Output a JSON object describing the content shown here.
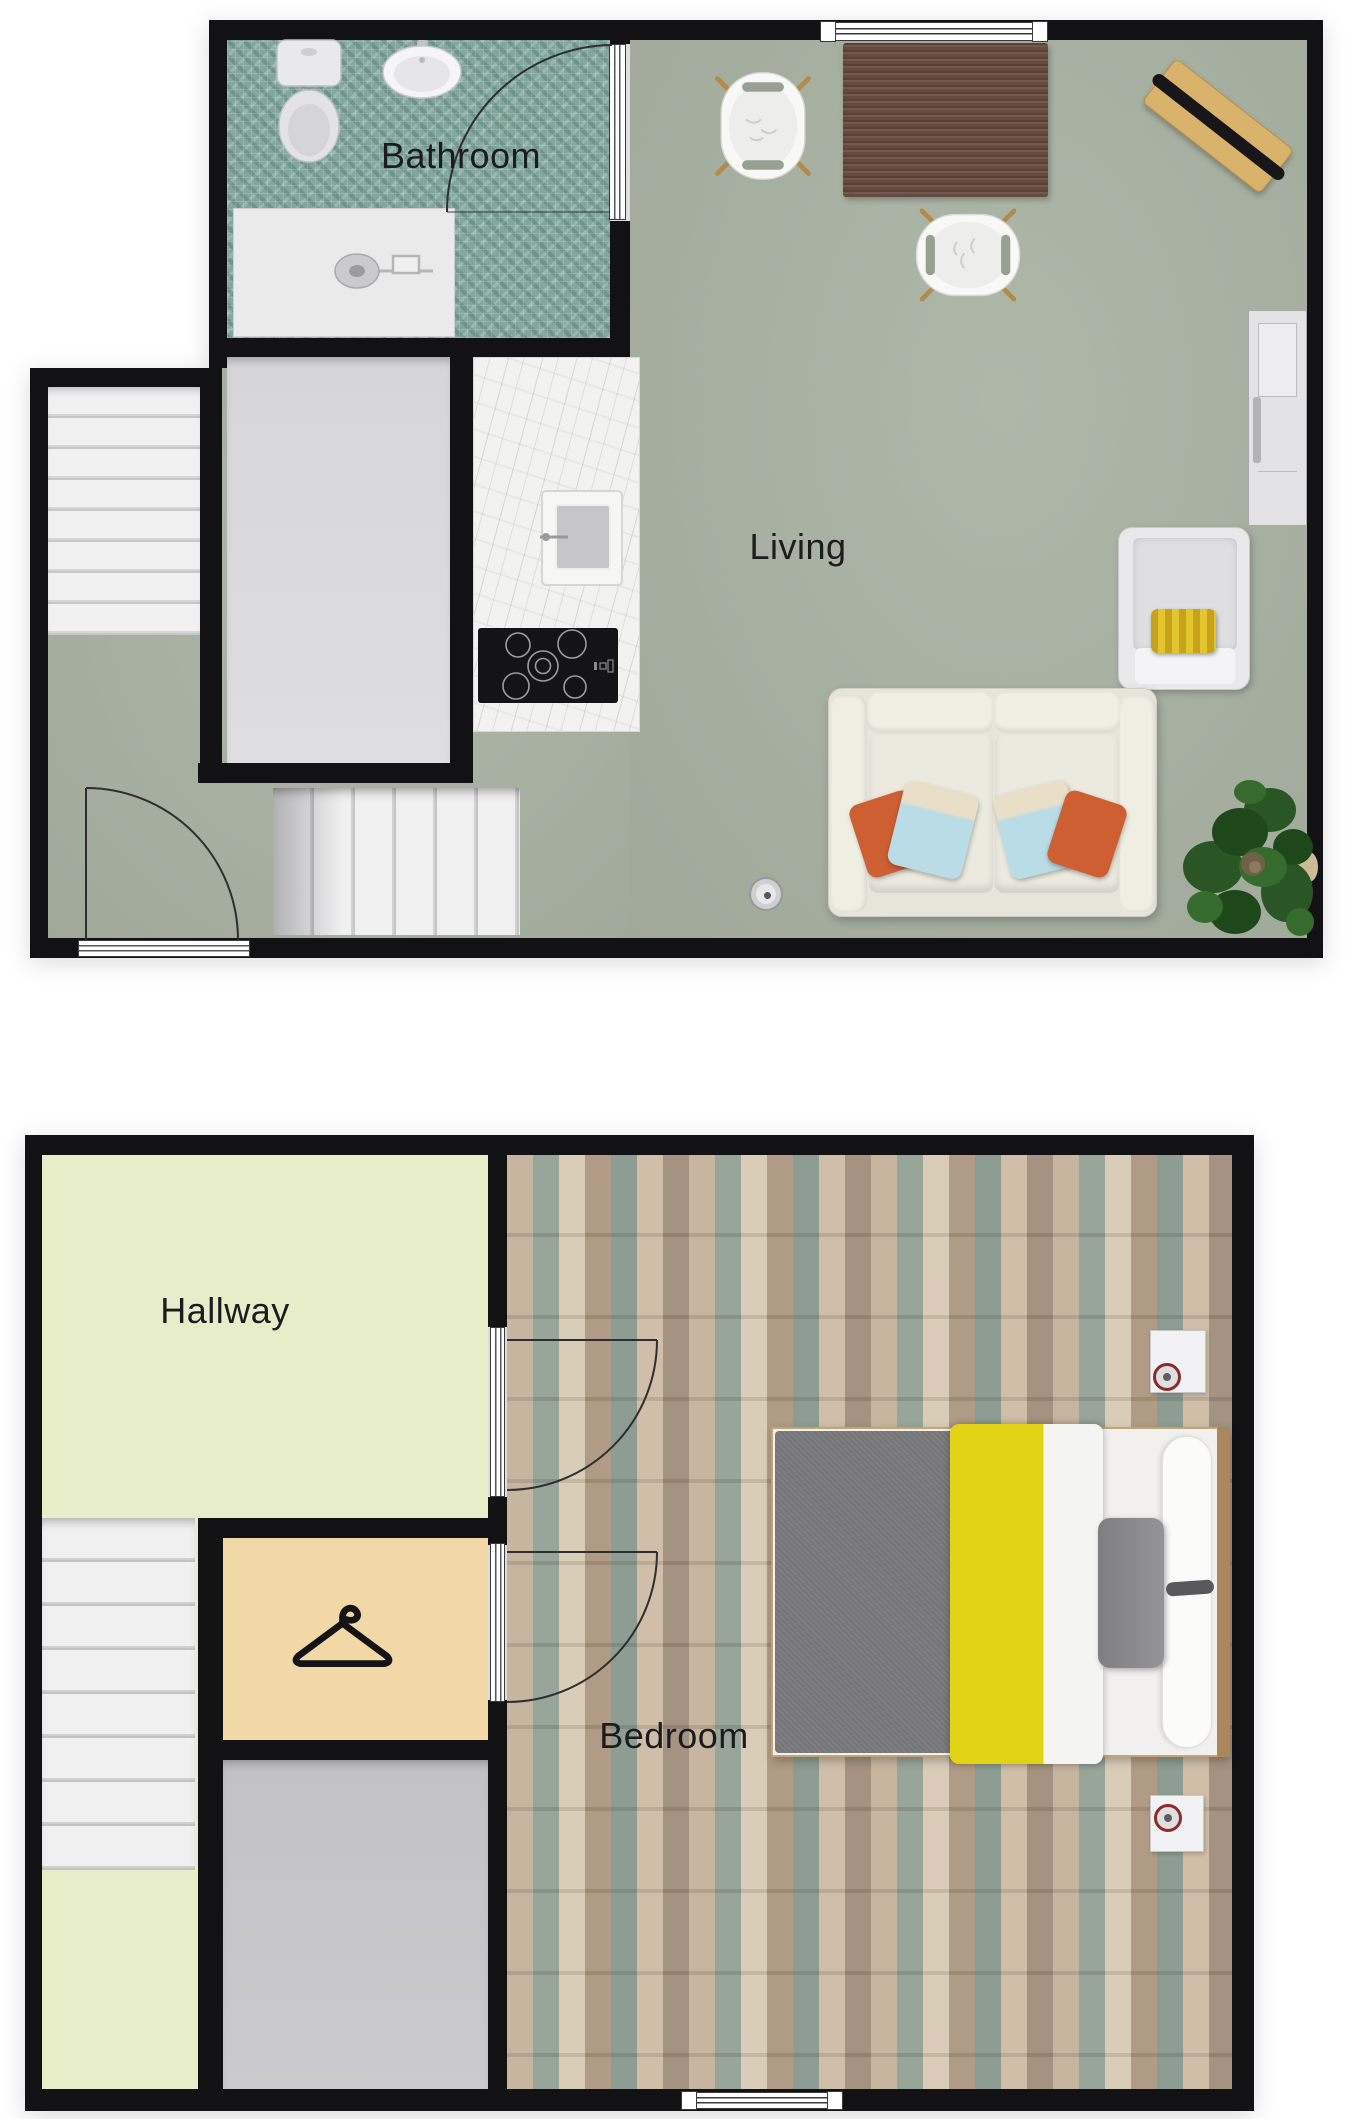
{
  "document": {
    "type": "floor-plan",
    "background": "#ffffff"
  },
  "labels": {
    "bathroom": "Bathroom",
    "living": "Living",
    "hallway": "Hallway",
    "bedroom": "Bedroom"
  },
  "floors": [
    {
      "id": "upper",
      "room_labels": [
        "Bathroom",
        "Living"
      ],
      "features": [
        "toilet",
        "wash-basin",
        "shower",
        "bathroom-door",
        "staircase-up",
        "storage-room",
        "kitchen-counter",
        "kitchen-sink",
        "cooktop",
        "window",
        "dining-table",
        "two-dining-chairs",
        "wall-board-with-black-ski",
        "side-cabinet",
        "armchair-with-yellow-pillow",
        "two-seat-sofa-with-pillows",
        "floor-speaker",
        "potted-plant",
        "staircase-down",
        "entry-door"
      ]
    },
    {
      "id": "lower",
      "room_labels": [
        "Hallway",
        "Bedroom"
      ],
      "features": [
        "staircase-down",
        "wardrobe-with-hanger-symbol",
        "storage-room",
        "hallway-door",
        "wardrobe-door",
        "double-bed-with-yellow-duvet",
        "gray-blanket",
        "two-nightstands-with-red-ring-objects",
        "window"
      ]
    }
  ],
  "colors": {
    "page": "#ffffff",
    "wall": "#121214",
    "label-text": "#1c1c1e",
    "living-floor": "#a9b3a3",
    "hallway-floor": "#e7ecc9",
    "closet-floor": "#f3d8a7",
    "mosaic": "#84a69c",
    "marble": "#f2f2f0",
    "wood": "#b4a48f",
    "table-wood": "#6e5142",
    "duvet-yellow": "#e2d414",
    "blanket-gray": "#7b7b7d",
    "pillow-orange": "#cd5f33",
    "pillow-blue": "#b9dce6",
    "pillow-cream": "#e9dfc9",
    "armchair-pillow-yellow": "#d8b422",
    "sofa-cream": "#e7e4da",
    "desk-tan": "#d9b26b",
    "headboard-tan": "#ab875d",
    "plant-green": "#2a5524"
  }
}
